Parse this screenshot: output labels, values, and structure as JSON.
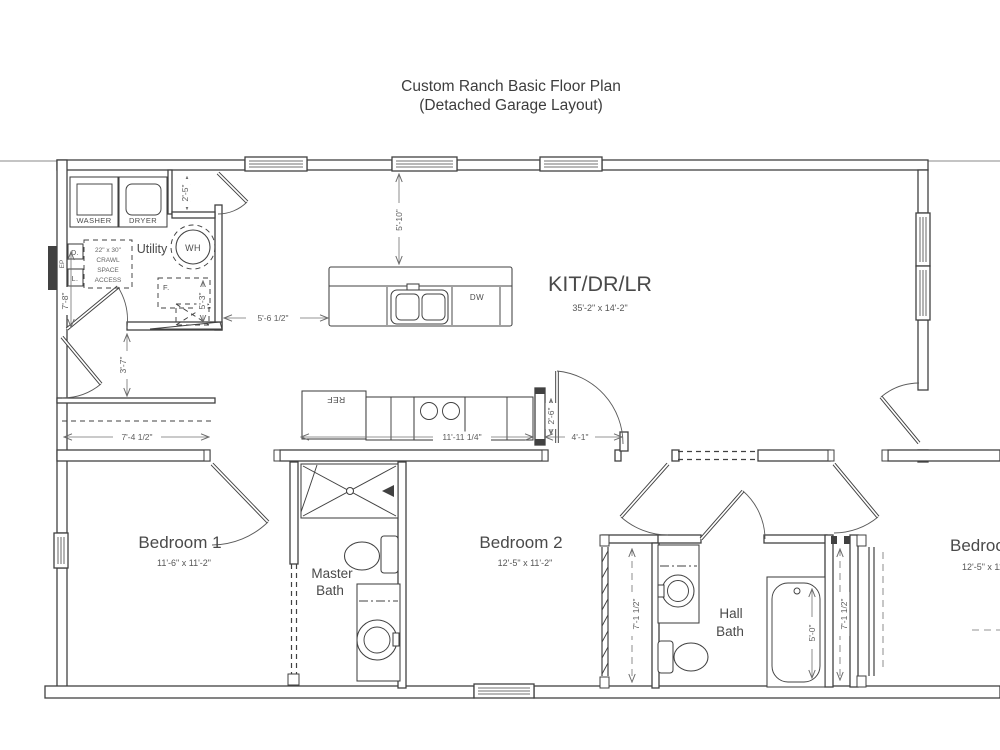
{
  "title": {
    "line1": "Custom Ranch Basic Floor Plan",
    "line2": "(Detached Garage Layout)"
  },
  "rooms": {
    "kitchen": {
      "label": "KIT/DR/LR",
      "dims": "35'-2\" x 14'-2\""
    },
    "utility": {
      "label": "Utility"
    },
    "bedroom1": {
      "label": "Bedroom 1",
      "dims": "11'-6\" x 11'-2\""
    },
    "bedroom2": {
      "label": "Bedroom 2",
      "dims": "12'-5\" x 11'-2\""
    },
    "bedroom3": {
      "label": "Bedroom 3",
      "dims": "12'-5\" x 11'-2\""
    },
    "master_bath": {
      "line1": "Master",
      "line2": "Bath"
    },
    "hall_bath": {
      "line1": "Hall",
      "line2": "Bath"
    }
  },
  "fixtures": {
    "washer": "WASHER",
    "dryer": "DRYER",
    "water_heater": "WH",
    "dishwasher": "DW",
    "refrigerator": "REF",
    "furnace": "F.",
    "d_box": "D.",
    "l_box": "L.",
    "electrical_panel": "EP"
  },
  "crawl_access": {
    "line1": "22\" x 30\"",
    "line2": "CRAWL",
    "line3": "SPACE",
    "line4": "ACCESS"
  },
  "dimensions": {
    "niche_width": "2'-5\"",
    "window_to_island": "5'-10\"",
    "island_clearance": "5'-6 1/2\"",
    "furnace_closet": "5'-3\"",
    "utility_width": "7'-8\"",
    "hall_width": "3'-7\"",
    "closet1_width": "7'-4 1/2\"",
    "counter_run": "11'-11 1/4\"",
    "nook_depth": "2'-6\"",
    "nook_width": "4'-1\"",
    "closet2_length": "7'-1 1/2\"",
    "closet3_length": "7'-1 1/2\"",
    "tub_length": "5'-0\""
  },
  "colors": {
    "wall": "#414141",
    "dim": "#707070",
    "text": "#3d3d3d",
    "background": "#ffffff"
  }
}
